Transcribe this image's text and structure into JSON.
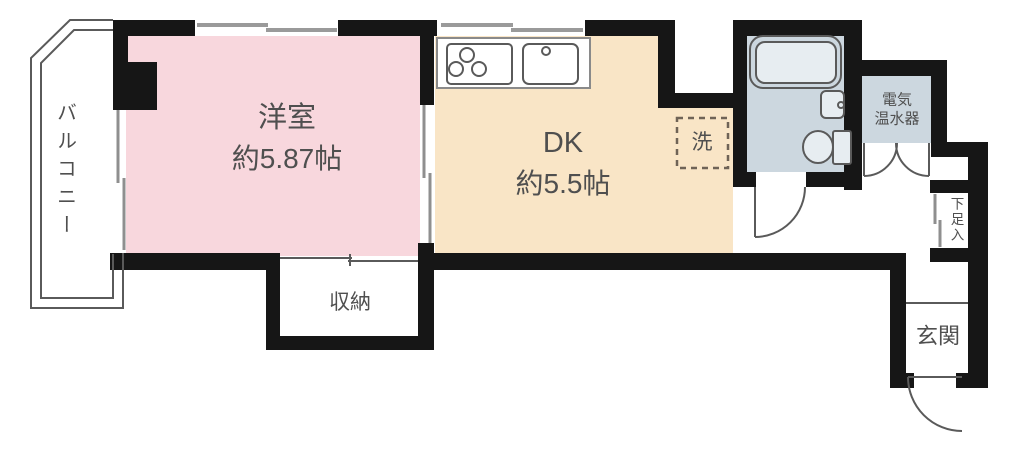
{
  "colors": {
    "wall": "#161616",
    "western_room_fill": "#f8d7dd",
    "dk_fill": "#f9e5c6",
    "bath_fill": "#ccd7df",
    "label_text": "#4f4f4f",
    "fixture_stroke": "#5a5a5a",
    "window_gray": "#9a9a9a"
  },
  "rooms": {
    "balcony": {
      "label": "バルコニー"
    },
    "western_room": {
      "name": "洋室",
      "size": "約5.87帖"
    },
    "dining_kitchen": {
      "name": "DK",
      "size": "約5.5帖"
    },
    "storage": {
      "label": "収納"
    },
    "laundry_space": {
      "label": "洗"
    },
    "water_heater": {
      "line1": "電気",
      "line2": "温水器"
    },
    "shoe_cabinet": {
      "label": "下足入"
    },
    "entrance": {
      "label": "玄関"
    }
  },
  "fixtures": {
    "stove": "three-burner-stove-icon",
    "kitchen_sink": "kitchen-sink-icon",
    "bathtub": "bathtub-icon",
    "washbasin": "washbasin-icon",
    "toilet": "toilet-icon",
    "washer_space": "washing-machine-dashed-box",
    "doors": [
      "bathroom-swing-door",
      "water-heater-double-door",
      "entrance-swing-door"
    ],
    "sliding_doors": [
      "balcony-sliding-door",
      "room-partition-sliding-door",
      "storage-sliding-door",
      "shoe-cabinet-sliding-door"
    ],
    "windows": [
      "western-room-window",
      "kitchen-window"
    ]
  }
}
